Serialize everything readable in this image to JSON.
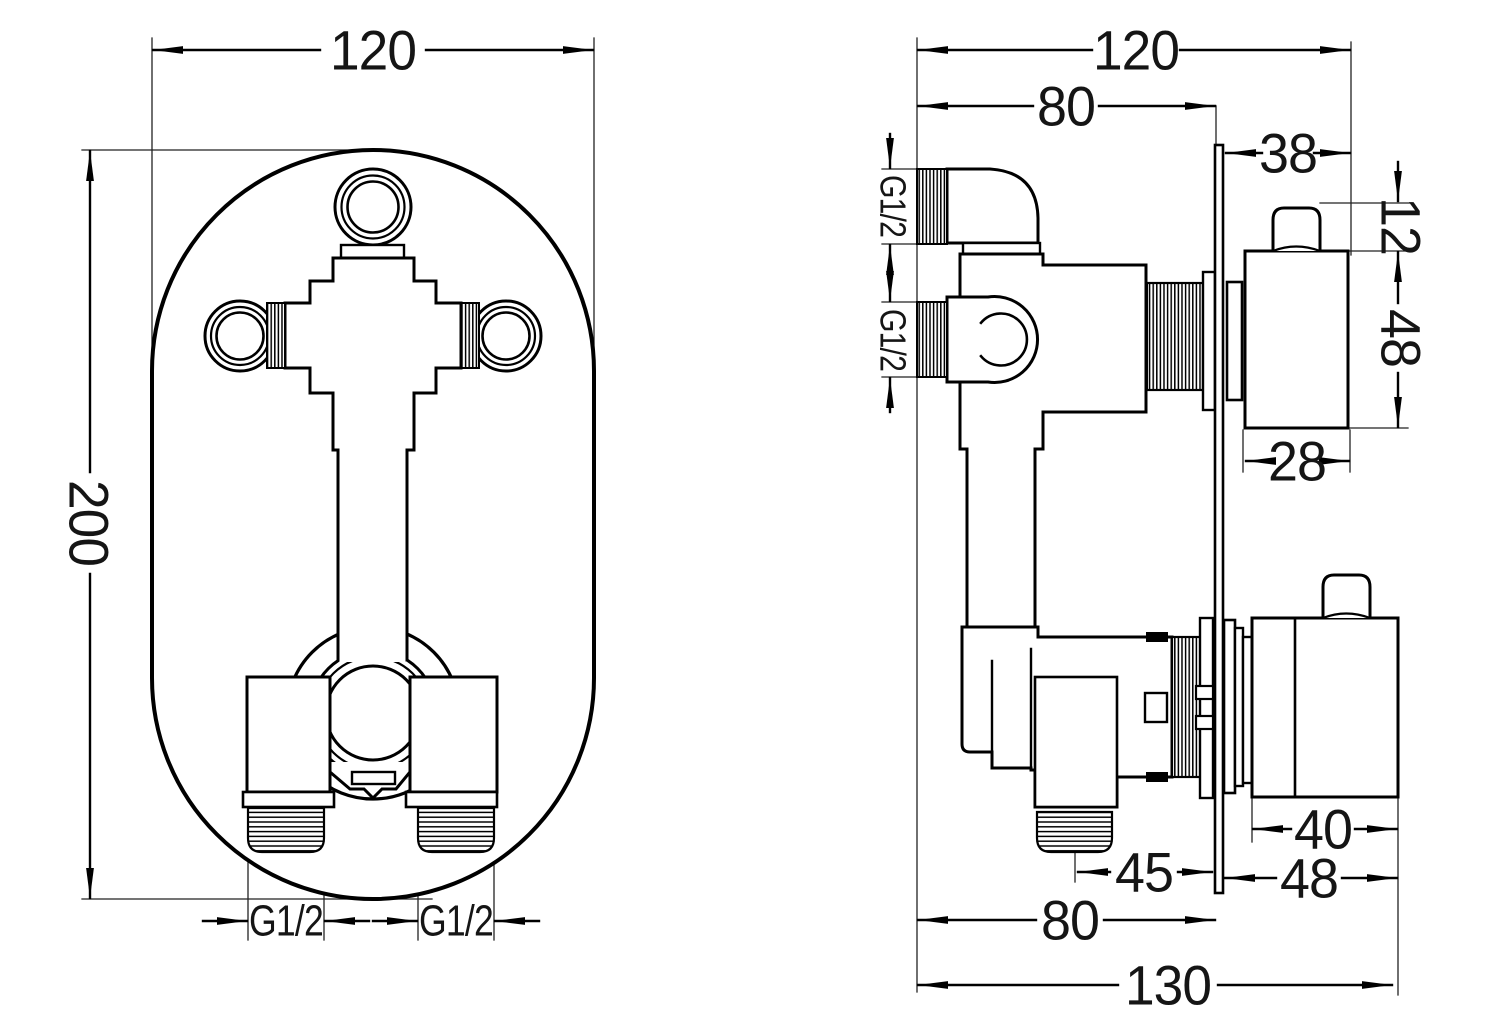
{
  "canvas": {
    "width": 1035,
    "height": 1035,
    "background": "#ffffff",
    "line_color": "#000000"
  },
  "front_view": {
    "name": "concealed shower valve - front view",
    "dims": {
      "width": "120",
      "height": "200",
      "thread_left": "G1/2",
      "thread_right": "G1/2"
    }
  },
  "side_view": {
    "name": "concealed shower valve - side view",
    "dims": {
      "overall_width": "120",
      "recess_depth": "80",
      "plate_to_knob": "38",
      "knob_stem": "12",
      "knob_height": "48",
      "knob_depth": "28",
      "inlet_top": "G1/2",
      "inlet_mid": "G1/2",
      "lower_knob_depth": "40",
      "plate_to_lower_knob": "48",
      "outlet_to_plate": "45",
      "recess_depth_bottom": "80",
      "overall_depth": "130"
    }
  }
}
